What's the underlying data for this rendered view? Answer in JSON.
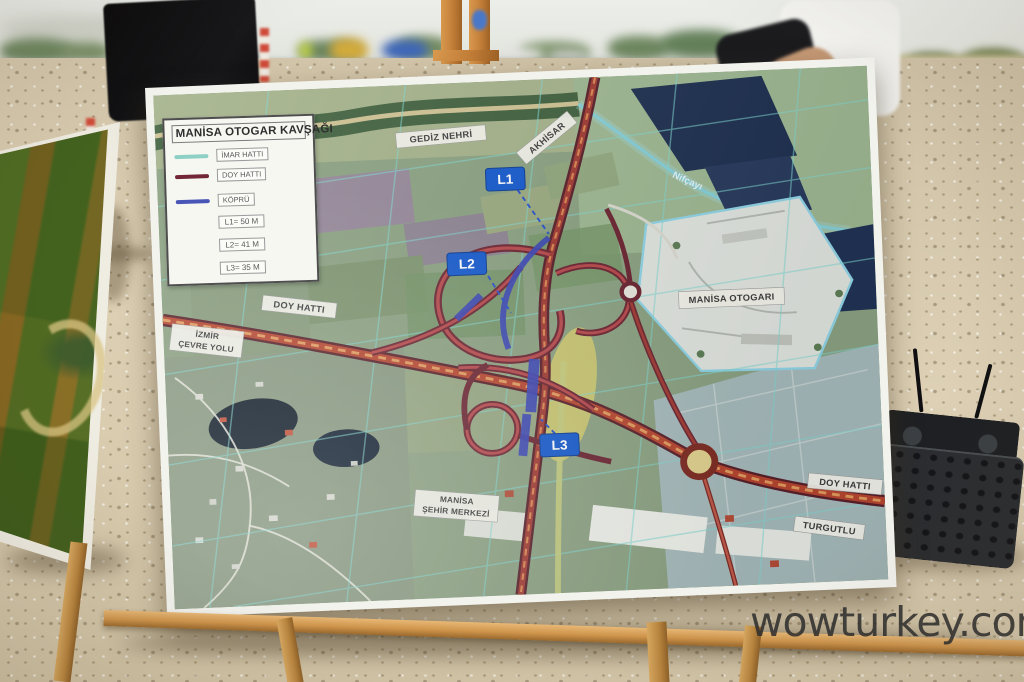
{
  "scene": {
    "watermark": "wowturkey.com"
  },
  "legend": {
    "title": "MANİSA OTOGAR KAVŞAĞI",
    "line_items": [
      {
        "label": "İMAR HATTI",
        "color": "#8fd0c6"
      },
      {
        "label": "DOY HATTI",
        "color": "#722636"
      },
      {
        "label": "KÖPRÜ",
        "color": "#4a55b8"
      }
    ],
    "measurements": [
      {
        "label": "L1= 50 M"
      },
      {
        "label": "L2= 41 M"
      },
      {
        "label": "L3= 35 M"
      }
    ]
  },
  "map": {
    "signs": {
      "l1": "L1",
      "l2": "L2",
      "l3": "L3"
    },
    "labels": {
      "gediz_nehri": "GEDİZ NEHRİ",
      "akhisar": "AKHİSAR",
      "nif_cayi": "Nifçayı",
      "manisa_otogari": "MANİSA OTOGARI",
      "doy_hatti_west": "DOY HATTI",
      "izmir_line1": "İZMİR",
      "izmir_line2": "ÇEVRE YOLU",
      "merkez_line1": "MANİSA",
      "merkez_line2": "ŞEHİR MERKEZİ",
      "doy_hatti_east": "DOY HATTI",
      "turgutlu": "TURGUTLU"
    },
    "colors": {
      "imar_hatti_grid": "#7fd6cf",
      "doy_hatti_line": "#722636",
      "kopru_bridge": "#3b46b5",
      "sign_blue": "#1559cc"
    }
  }
}
